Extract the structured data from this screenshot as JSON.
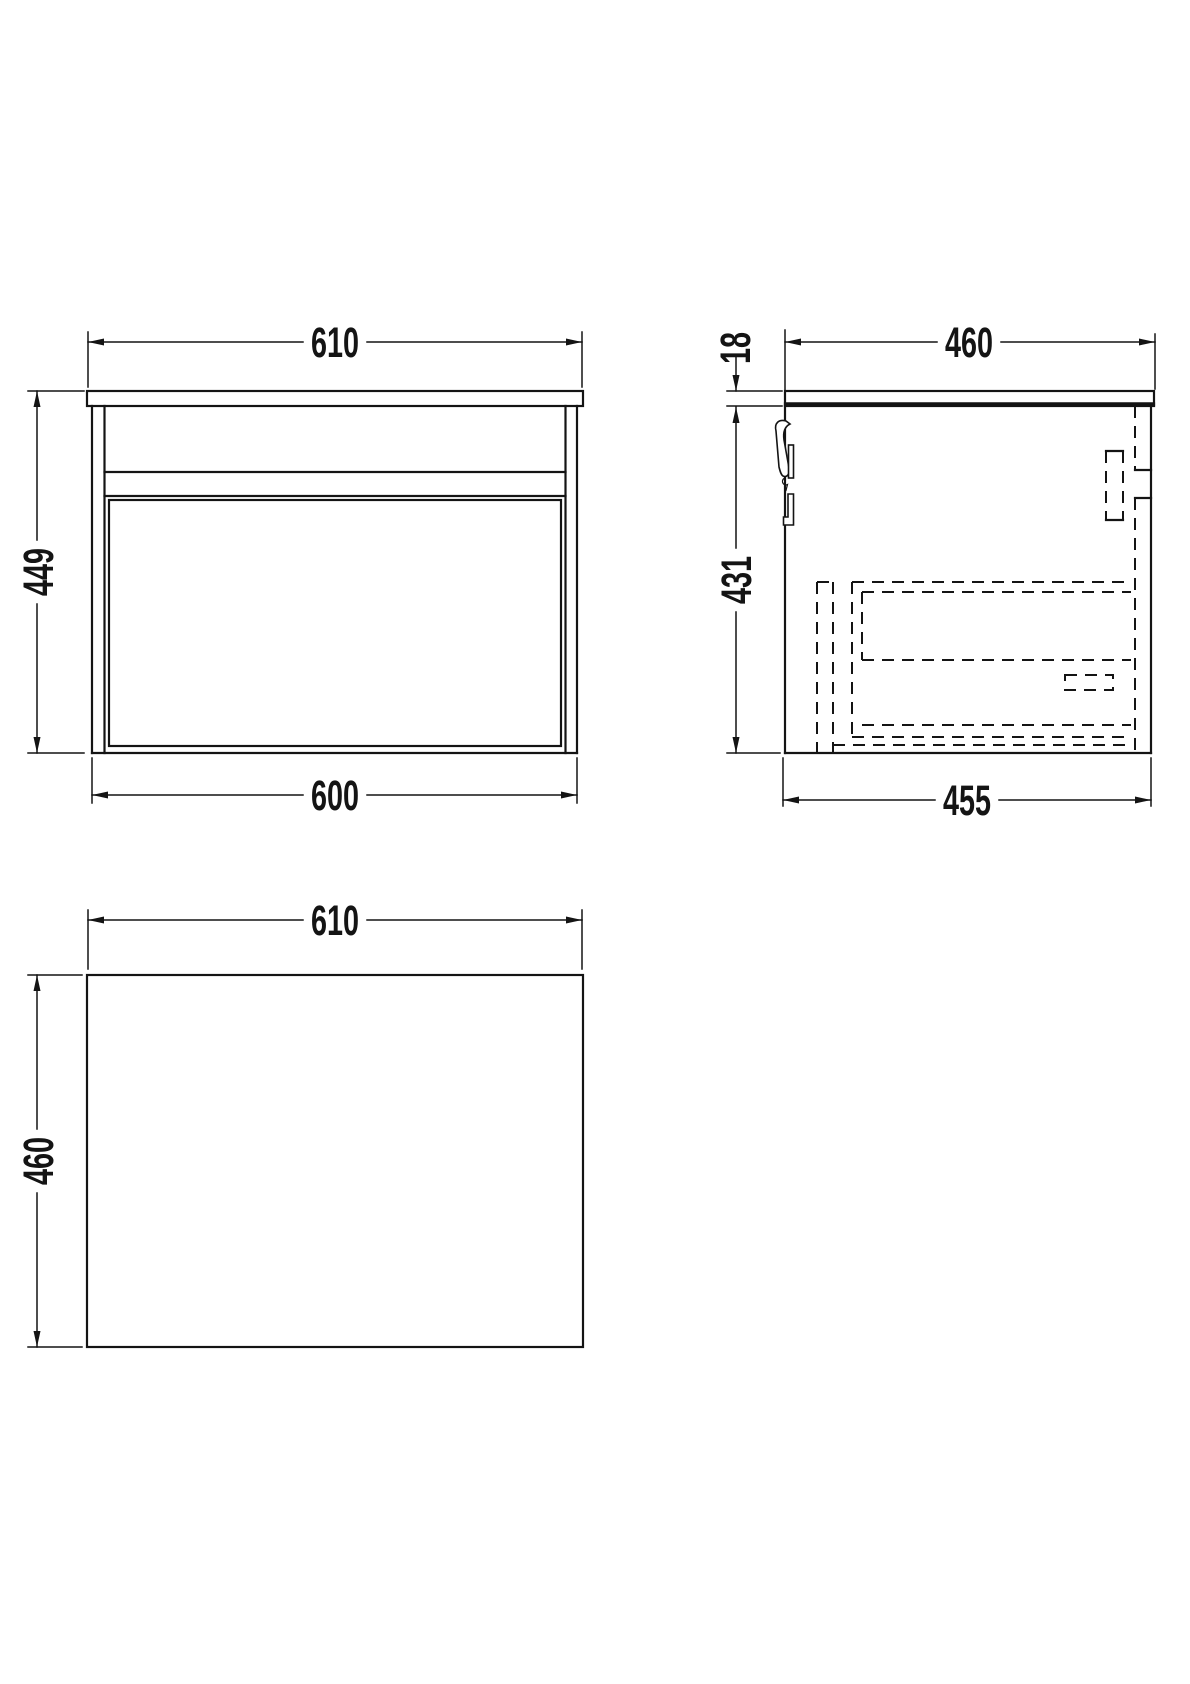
{
  "colors": {
    "line": "#141414",
    "background": "#ffffff"
  },
  "views": {
    "front_elevation": {
      "width_top": "610",
      "height_overall": "449",
      "width_cabinet": "600"
    },
    "side_elevation": {
      "depth_worktop": "460",
      "worktop_thickness": "18",
      "height_cabinet": "431",
      "depth_cabinet": "455"
    },
    "plan_view": {
      "width": "610",
      "depth": "460"
    }
  }
}
